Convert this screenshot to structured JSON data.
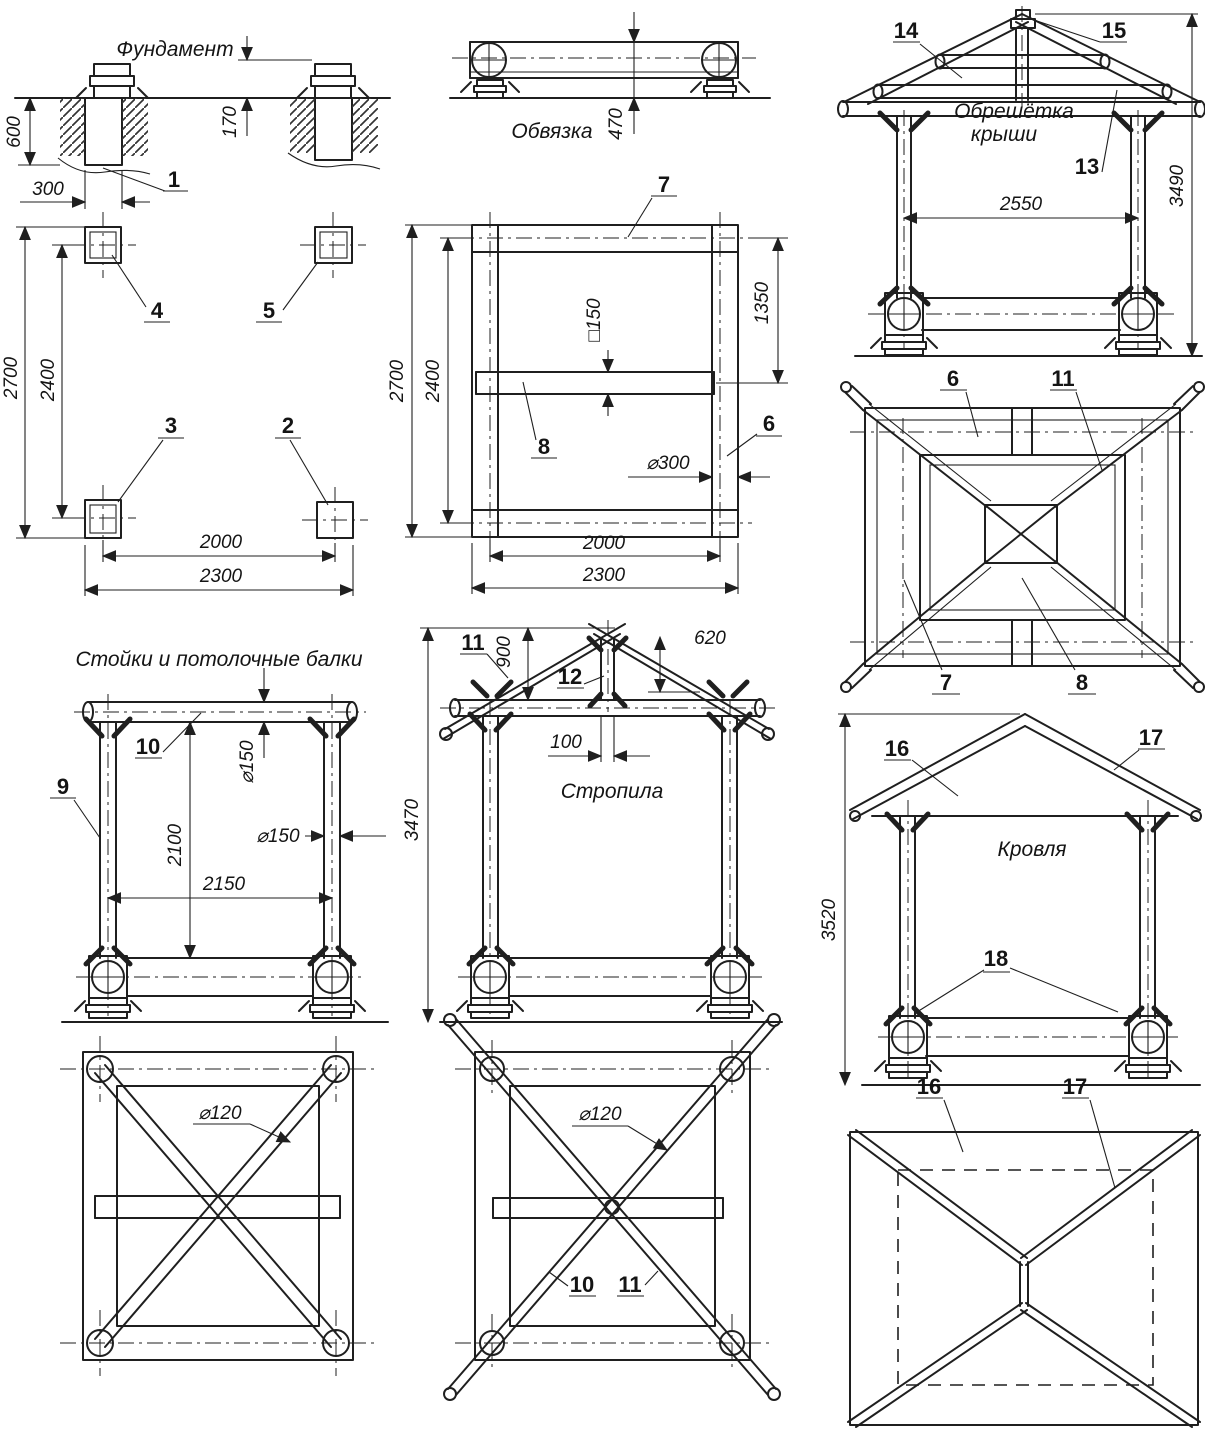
{
  "views": {
    "foundation_section": {
      "title": "Фундамент",
      "dims": {
        "depth": "600",
        "cap_height": "170",
        "width": "300"
      },
      "callouts": {
        "pier": "1"
      }
    },
    "foundation_plan": {
      "dims": {
        "outer_y": "2700",
        "center_y": "2400",
        "center_x": "2000",
        "outer_x": "2300"
      },
      "callouts": {
        "tl": "4",
        "tr": "5",
        "bl": "3",
        "br": "2"
      }
    },
    "strapping_side": {
      "title": "Обвязка",
      "dims": {
        "height": "470"
      }
    },
    "strapping_plan": {
      "dims": {
        "outer_y": "2700",
        "center_y": "2400",
        "beam_offset": "1350",
        "beam_section": "□150",
        "log_dia": "⌀300",
        "center_x": "2000",
        "outer_x": "2300"
      },
      "callouts": {
        "frame": "7",
        "beam": "8",
        "side_log": "6"
      }
    },
    "lathing_elevation": {
      "title_line1": "Обрешётка",
      "title_line2": "крыши",
      "dims": {
        "span": "2550",
        "height": "3490"
      },
      "callouts": {
        "purlin": "14",
        "kingpost_top": "15",
        "slope_board": "13"
      }
    },
    "lathing_plan": {
      "callouts": {
        "ceiling_log": "6",
        "rafter": "11",
        "side_log": "7",
        "beam": "8"
      }
    },
    "posts_elevation": {
      "title": "Стойки и потолочные балки",
      "dims": {
        "beam_dia": "⌀150",
        "post_dia": "⌀150",
        "height": "2100",
        "span": "2150"
      },
      "callouts": {
        "beam": "10",
        "post": "9"
      }
    },
    "posts_plan": {
      "dims": {
        "brace_dia": "⌀120"
      }
    },
    "rafters_elevation": {
      "title": "Стропила",
      "dims": {
        "rise": "900",
        "overhang": "620",
        "kingpost": "100",
        "total_height": "3470"
      },
      "callouts": {
        "rafter": "11",
        "kingpost": "12"
      }
    },
    "rafters_plan": {
      "dims": {
        "brace_dia": "⌀120"
      },
      "callouts": {
        "beam": "10",
        "rafter": "11"
      }
    },
    "roofing_elevation": {
      "title": "Кровля",
      "dims": {
        "total_height": "3520"
      },
      "callouts": {
        "roof_board": "16",
        "ridge_board": "17",
        "braces": "18"
      }
    },
    "roofing_plan": {
      "callouts": {
        "roof_board": "16",
        "ridge_board": "17"
      }
    }
  }
}
